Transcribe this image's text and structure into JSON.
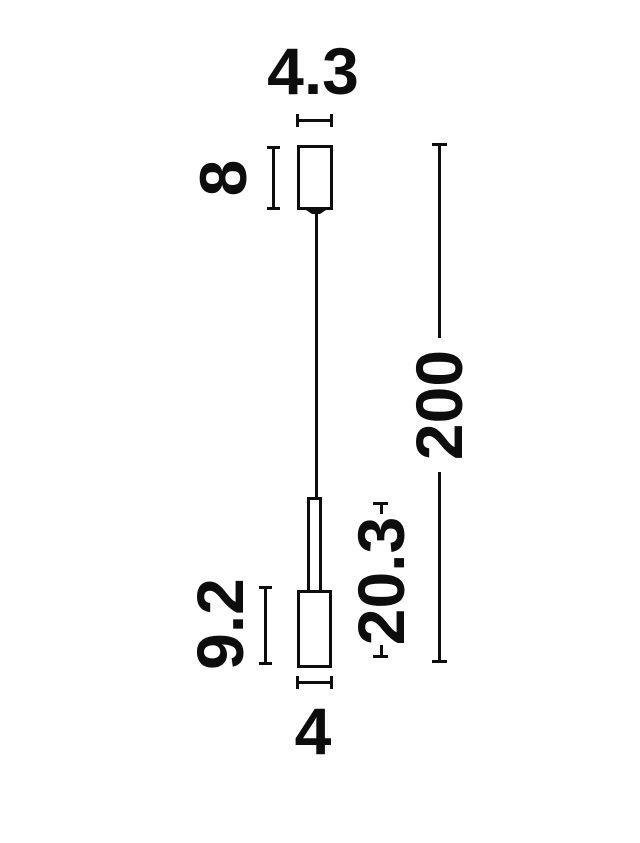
{
  "page": {
    "background_color": "#ffffff",
    "line_color": "#0d0d0d"
  },
  "diagram": {
    "type": "technical-dimension-drawing",
    "subject": "pendant-lamp-front-view",
    "labels": {
      "canopy_width": "4.3",
      "canopy_height": "8",
      "total_drop": "200",
      "lower_assembly_height": "20.3",
      "head_height": "9.2",
      "head_width": "4"
    }
  }
}
